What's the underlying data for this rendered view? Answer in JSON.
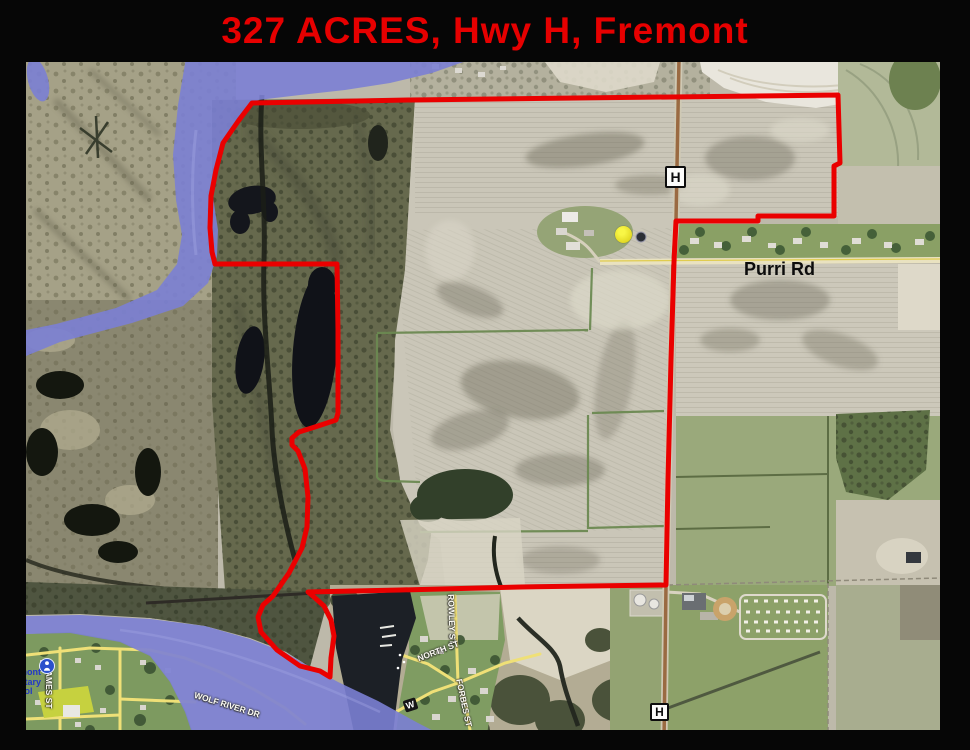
{
  "title": "327 ACRES, Hwy H, Fremont",
  "map": {
    "highway_shield": "H",
    "labels": {
      "purri_rd": "Purri Rd",
      "james_st": "JAMES ST",
      "rowley_st": "ROWLEY ST",
      "north_st": "NORTH ST",
      "forbes_st": "FORBES ST",
      "wolf_river_dr": "WOLF RIVER DR",
      "w_marker": "W"
    },
    "school": {
      "line1": "mont",
      "line2": "ntary",
      "line3": "ool"
    },
    "colors": {
      "title_red": "#e60000",
      "boundary_red": "#ea0000",
      "river_blue": "#7b80d4",
      "street_yellow": "#efe077",
      "highway_brown": "#9a6a42"
    }
  }
}
